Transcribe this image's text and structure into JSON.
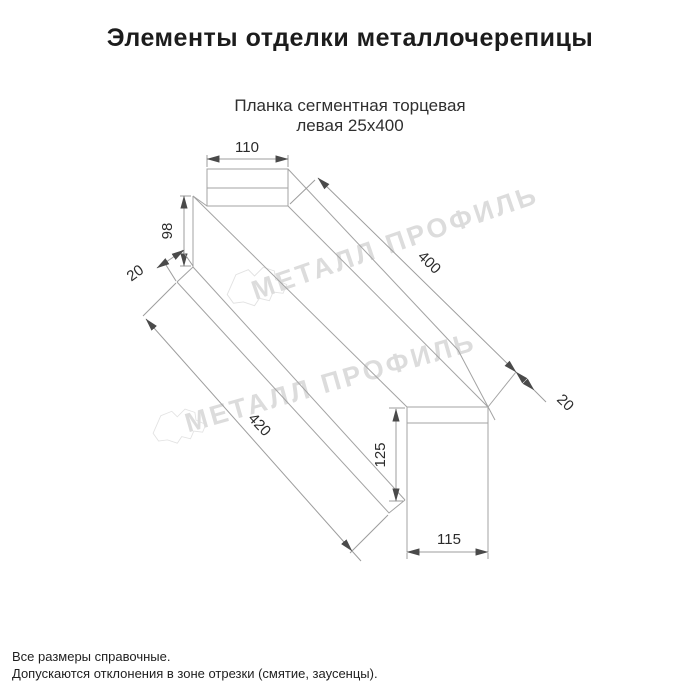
{
  "title": "Элементы отделки металлочерепицы",
  "subtitle": {
    "line1": "Планка сегментная торцевая",
    "line2": "левая 25х400"
  },
  "drawing": {
    "dims": {
      "d110": "110",
      "d98": "98",
      "d20_near": "20",
      "d400": "400",
      "d20_far": "20",
      "d420": "420",
      "d125": "125",
      "d115": "115"
    },
    "watermark": "МЕТАЛЛ ПРОФИЛЬ"
  },
  "footer": {
    "line1": "Все размеры справочные.",
    "line2": "Допускаются отклонения в зоне отрезки (смятие, заусенцы)."
  },
  "colors": {
    "outline": "#a3a3a3",
    "dimension_text": "#2b2b2b",
    "watermark": "#dcdcdc",
    "title_text": "#1c1c1c",
    "background": "#ffffff"
  }
}
